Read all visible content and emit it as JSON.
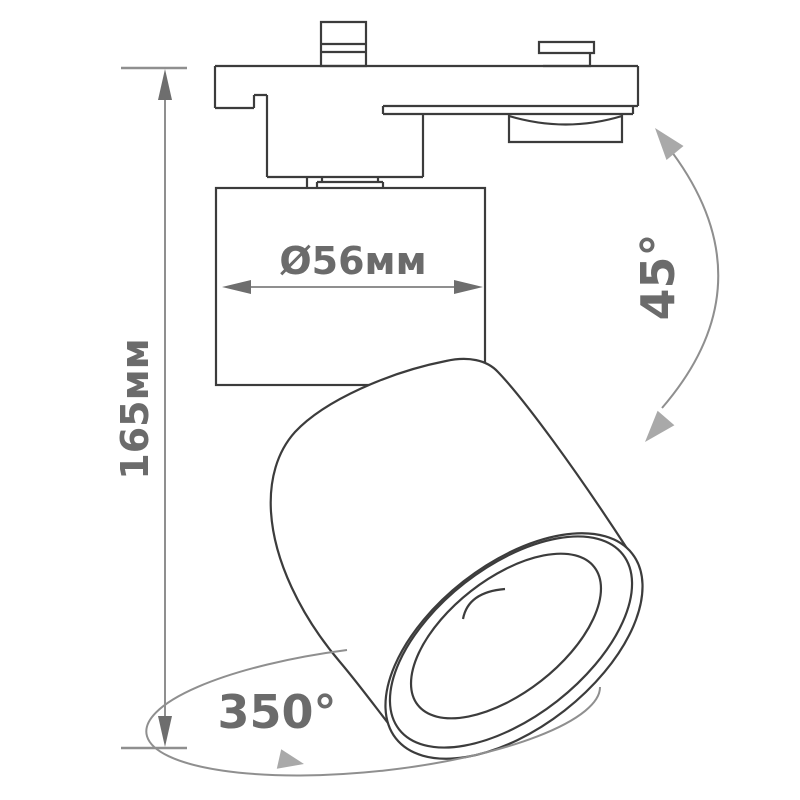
{
  "drawing": {
    "type": "technical-dimension-drawing",
    "subject": "track-spotlight",
    "dimensions": {
      "height": "165мм",
      "diameter": "Ø56мм",
      "tilt_angle": "45°",
      "rotation_angle": "350°"
    },
    "colors": {
      "background": "#ffffff",
      "outline": "#3c3c3c",
      "dimension_line": "#8f8f8f",
      "dimension_text": "#6b6b6b",
      "arc_arrowhead": "#a9a9a9"
    }
  }
}
